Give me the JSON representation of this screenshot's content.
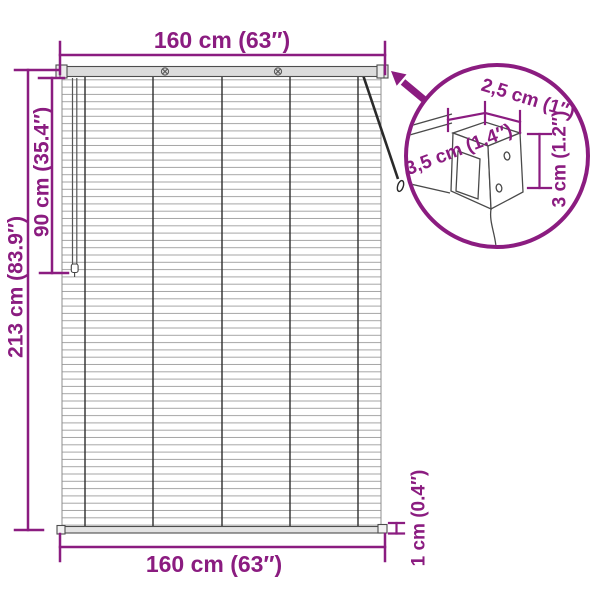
{
  "diagram": {
    "title": "window-blind-dimension-diagram",
    "dims": {
      "top_width": "160 cm (63″)",
      "bottom_width": "160 cm (63″)",
      "total_height": "213 cm (83.9″)",
      "partial_height": "90 cm (35.4″)",
      "slat_thickness": "1 cm (0.4″)"
    },
    "bracket_detail": {
      "width": "2,5 cm (1″)",
      "depth": "3,5 cm (1.4″)",
      "height": "3 cm (1.2″)"
    },
    "colors": {
      "accent": "#8B1C80",
      "slat_line": "#a6a6a6",
      "rail_fill": "#dcdcdc",
      "outline": "#4a4a4a",
      "cord": "#2e2e2e",
      "background": "#ffffff"
    }
  }
}
